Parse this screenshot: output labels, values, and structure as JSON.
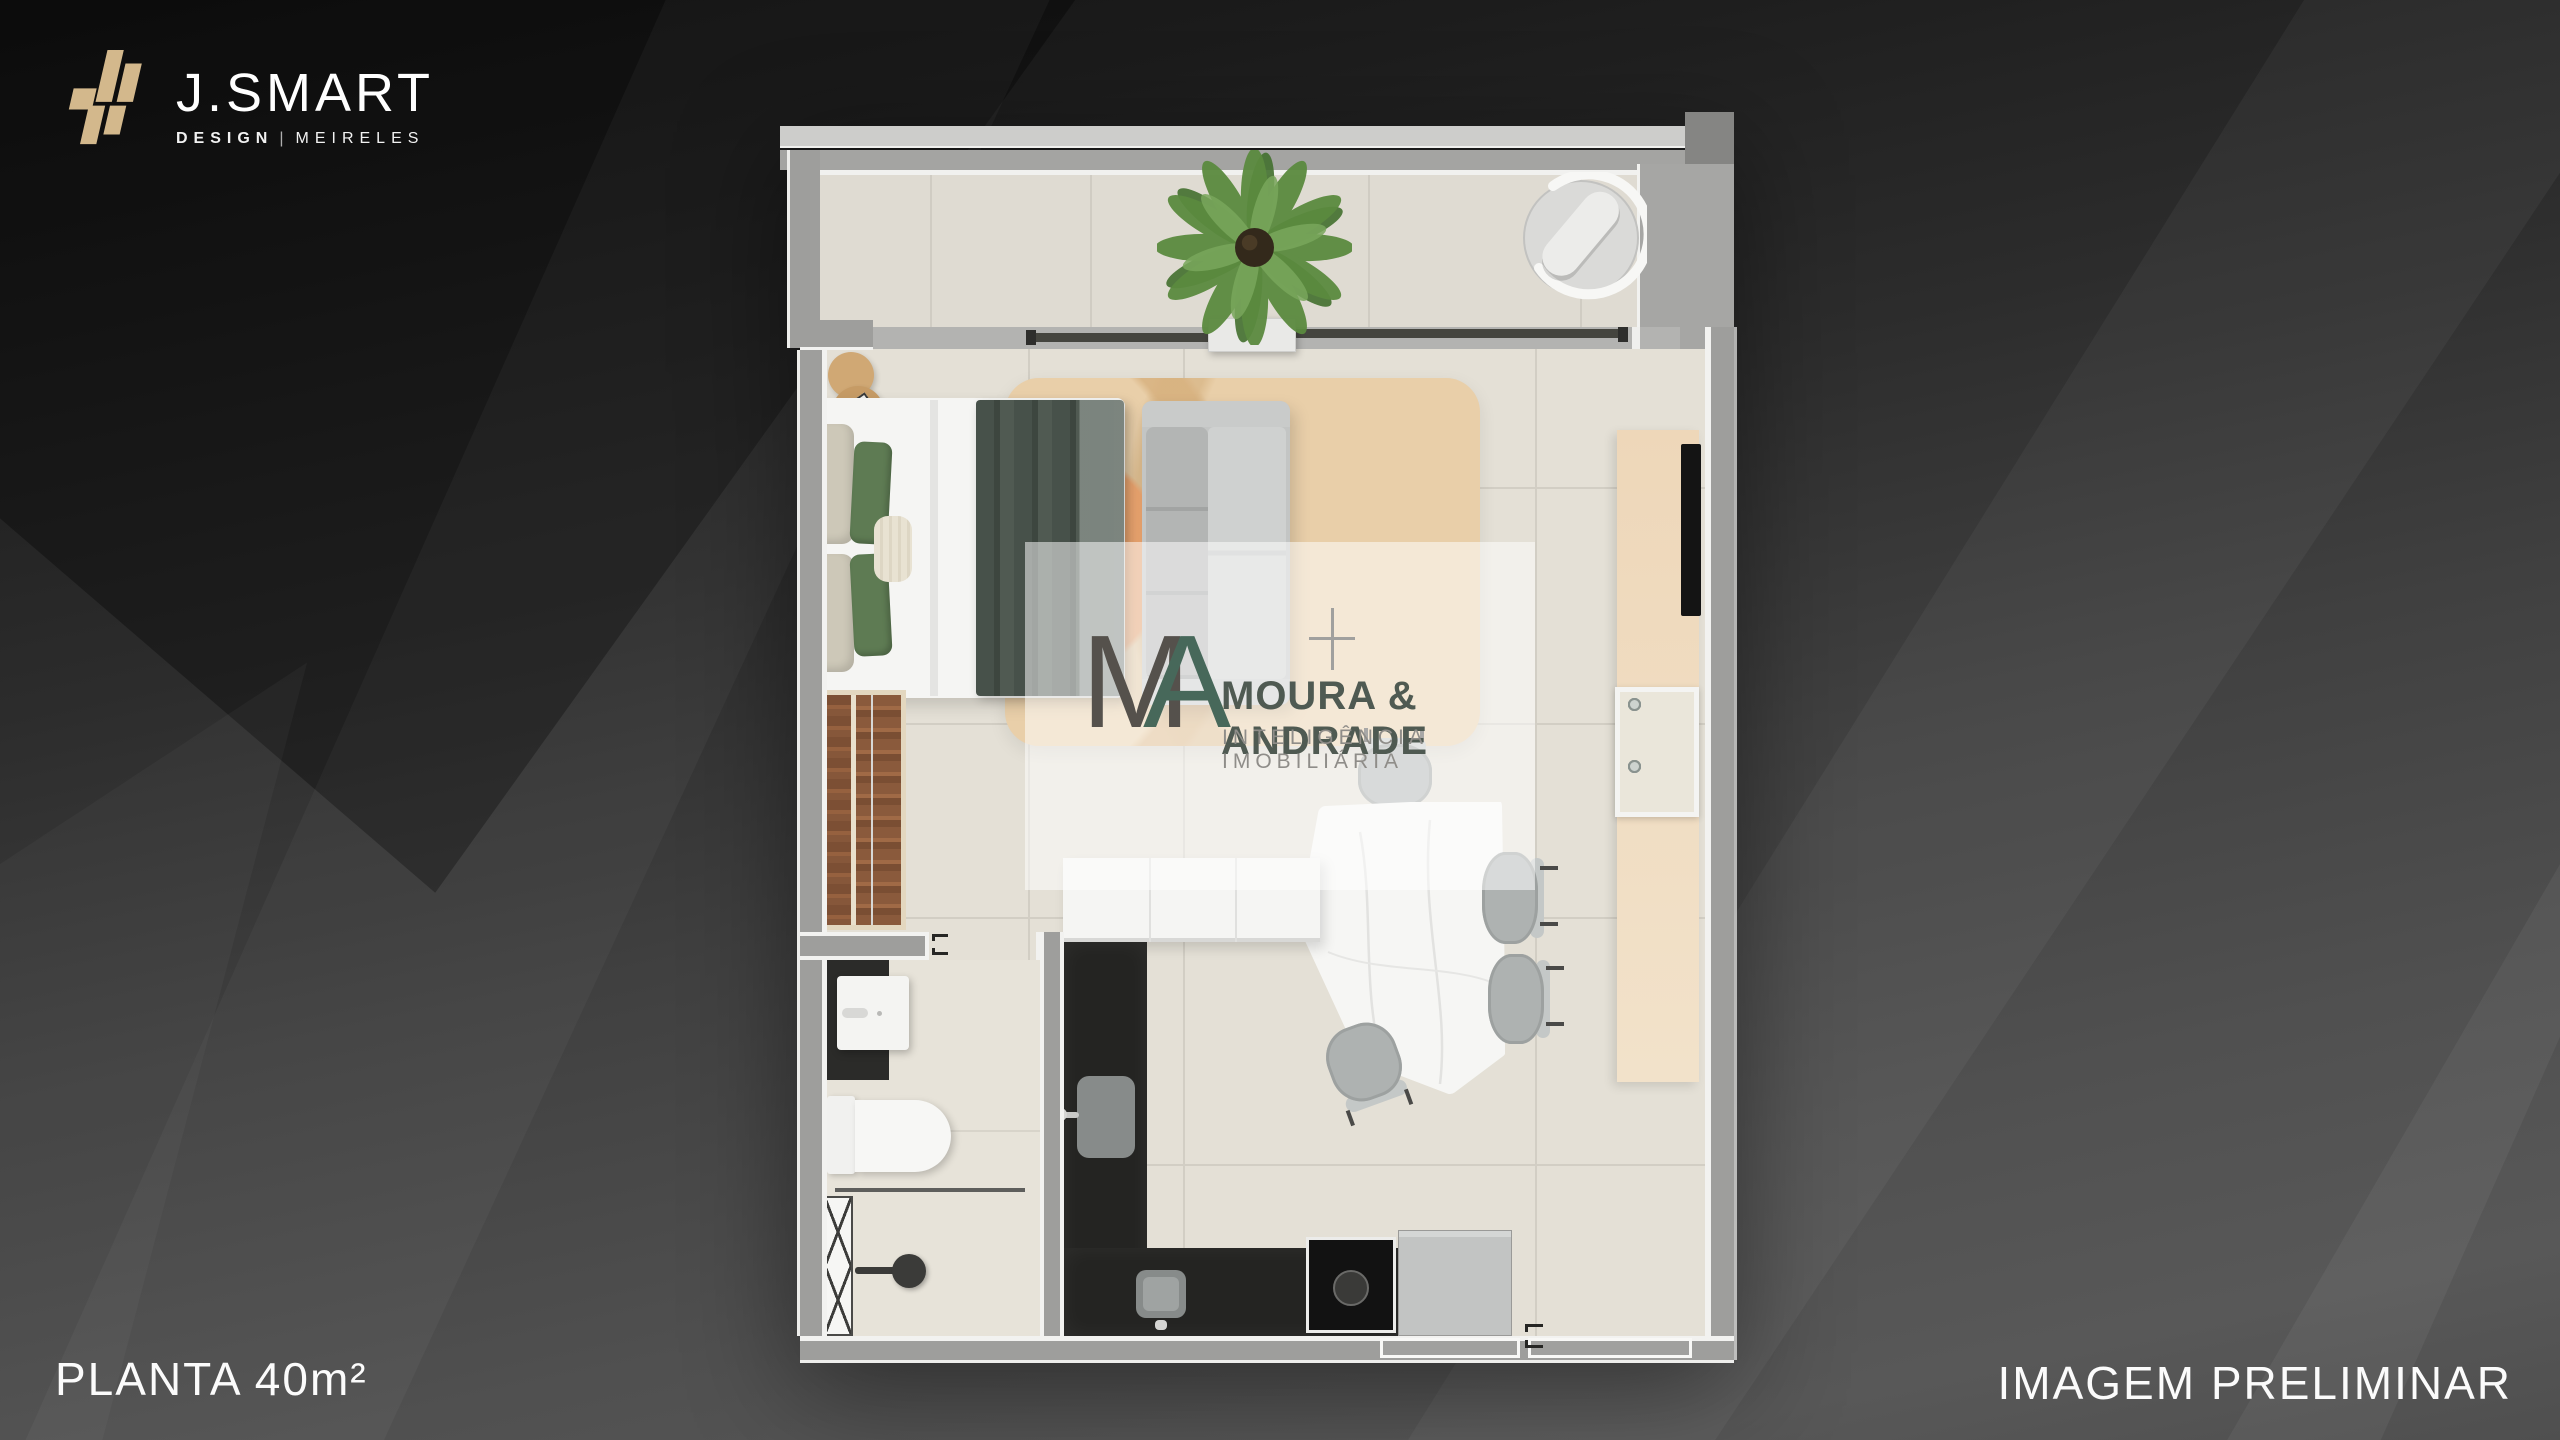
{
  "brand": {
    "name": "J.SMART",
    "sub_left": "DESIGN",
    "sub_divider": "|",
    "sub_right": "MEIRELES",
    "logo_gold": "#d3b88c"
  },
  "watermark": {
    "monogram_m": "M",
    "monogram_a": "A",
    "name": "MOURA & ANDRADE",
    "tagline": "INTELIGÊNCIA IMOBILIÁRIA",
    "teal": "#47685a",
    "gray": "#55514c"
  },
  "captions": {
    "left": "PLANTA 40m²",
    "right": "IMAGEM PRELIMINAR"
  },
  "palette": {
    "background_dark": "#121212",
    "background_light": "#585858",
    "wall_gray": "#9e9e9c",
    "slab_light": "#cdcdcb",
    "floor_beige": "#e4e0d6",
    "balcony_floor": "#dfdbd2",
    "counter_dark": "#242422",
    "wood_console": "#eed7b9",
    "wood_side_table": "#c69b65",
    "rug_tan": "#e9cfa9",
    "rug_orange": "#eca46e",
    "plant_green": "#5b8a3f",
    "pillow_green": "#5e7b53",
    "blanket_green": "#47514a",
    "sofa_gray": "#b6b8b7",
    "marble_white": "#f6f6f4"
  },
  "floorplan": {
    "areas": [
      "balcony",
      "bedroom",
      "living-dining",
      "kitchen",
      "bathroom"
    ],
    "furniture": [
      "palm-plant",
      "planter",
      "egg-lounge-chair",
      "sliding-door",
      "double-bed",
      "pillows",
      "blanket",
      "side-table",
      "sofa",
      "area-rug",
      "wardrobe",
      "tv-console",
      "tv",
      "spice-niche",
      "kitchen-island",
      "kitchen-counter",
      "kitchen-sink",
      "prep-sink",
      "cooktop",
      "refrigerator",
      "dining-table",
      "dining-chair",
      "vanity-sink",
      "toilet",
      "shower-partition",
      "shower-door",
      "shower-head",
      "bathroom-door",
      "entry-door"
    ]
  }
}
